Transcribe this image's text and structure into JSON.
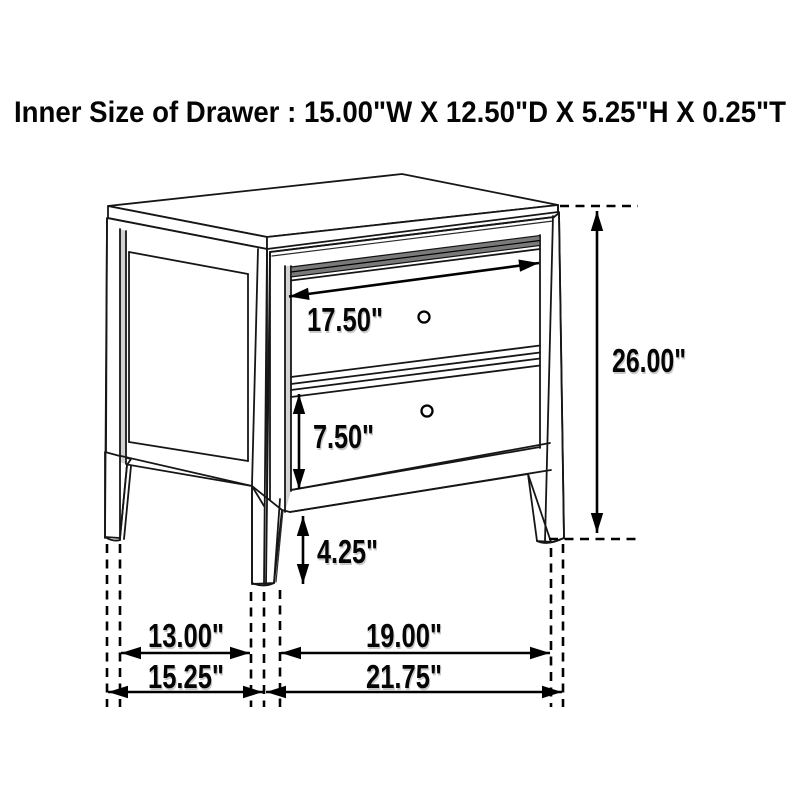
{
  "header": {
    "title": "Inner Size of Drawer : 15.00\"W X 12.50\"D X 5.25\"H X 0.25\"T"
  },
  "diagram": {
    "type": "furniture-dimension-drawing",
    "item": "two-drawer nightstand",
    "line_color": "#161616",
    "background": "#ffffff",
    "dimensions": {
      "drawer_front_width": {
        "label": "17.50\""
      },
      "overall_height": {
        "label": "26.00\""
      },
      "lower_drawer_height": {
        "label": "7.50\""
      },
      "floor_clearance": {
        "label": "4.25\""
      },
      "side_leg_gap": {
        "label": "13.00\""
      },
      "overall_depth": {
        "label": "15.25\""
      },
      "front_leg_gap": {
        "label": "19.00\""
      },
      "overall_width": {
        "label": "21.75\""
      }
    }
  }
}
